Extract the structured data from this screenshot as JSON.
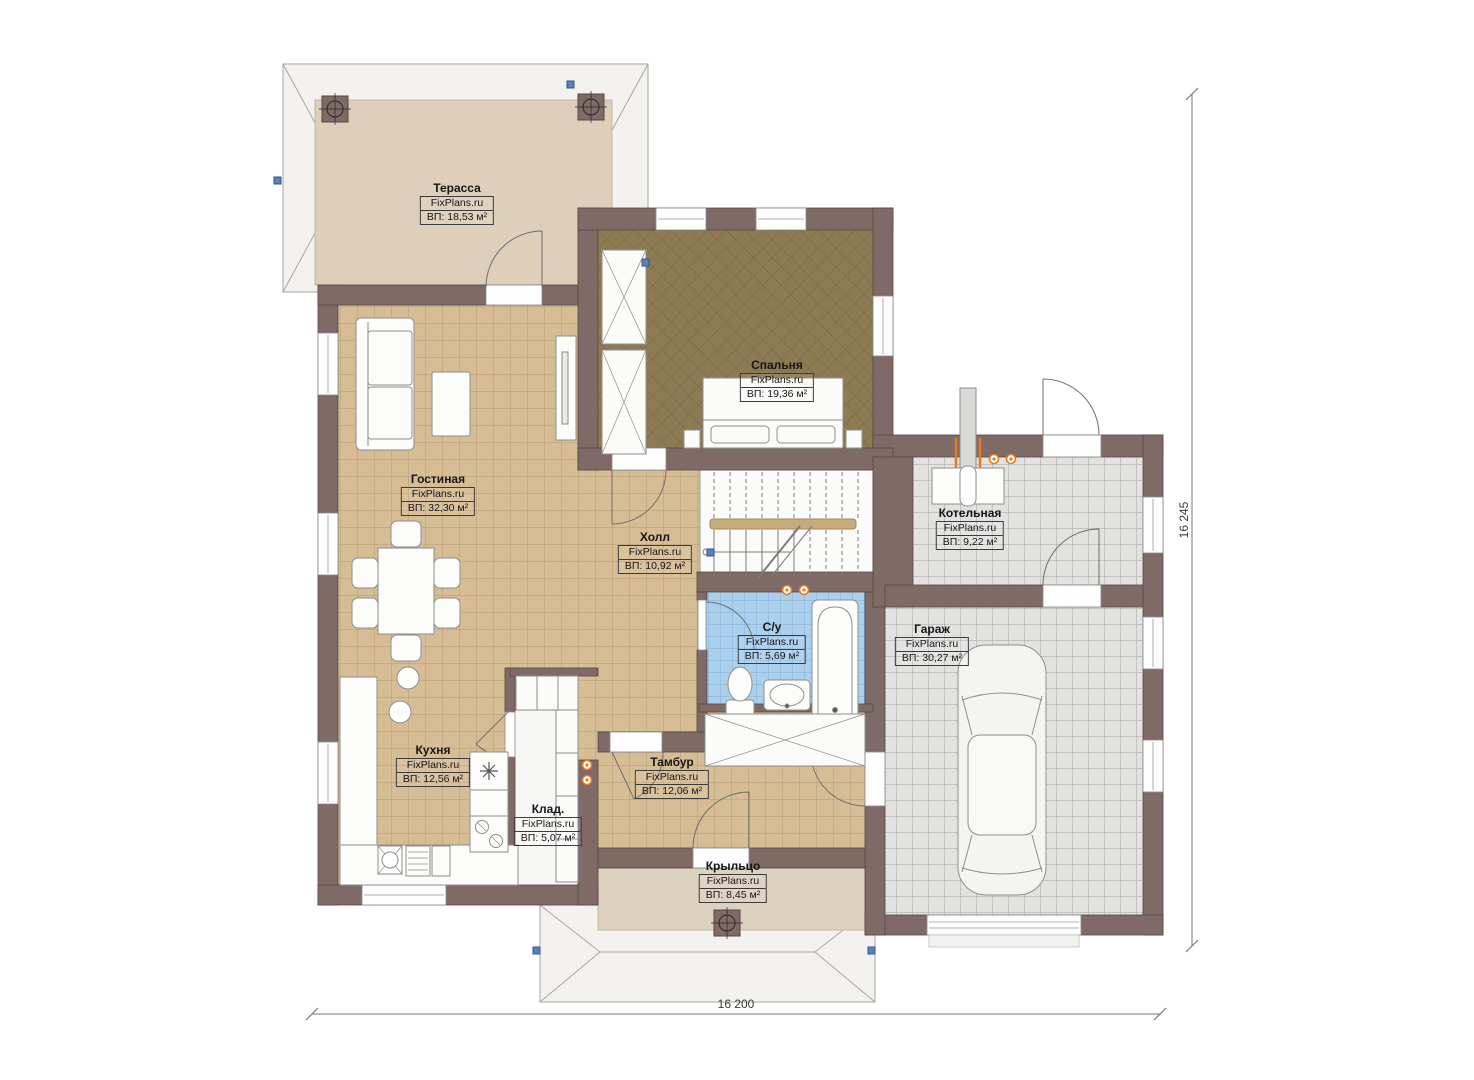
{
  "rooms": [
    {
      "key": "terrace",
      "name": "Терасса",
      "brand": "FixPlans.ru",
      "area": "ВП: 18,53 м²"
    },
    {
      "key": "bedroom",
      "name": "Спальня",
      "brand": "FixPlans.ru",
      "area": "ВП: 19,36 м²"
    },
    {
      "key": "living_room",
      "name": "Гостиная",
      "brand": "FixPlans.ru",
      "area": "ВП: 32,30 м²"
    },
    {
      "key": "hall",
      "name": "Холл",
      "brand": "FixPlans.ru",
      "area": "ВП: 10,92 м²"
    },
    {
      "key": "boiler_room",
      "name": "Котельная",
      "brand": "FixPlans.ru",
      "area": "ВП: 9,22 м²"
    },
    {
      "key": "bathroom",
      "name": "С/у",
      "brand": "FixPlans.ru",
      "area": "ВП: 5,69 м²"
    },
    {
      "key": "garage",
      "name": "Гараж",
      "brand": "FixPlans.ru",
      "area": "ВП: 30,27 м²"
    },
    {
      "key": "kitchen",
      "name": "Кухня",
      "brand": "FixPlans.ru",
      "area": "ВП: 12,56 м²"
    },
    {
      "key": "storage",
      "name": "Клад.",
      "brand": "FixPlans.ru",
      "area": "ВП: 5,07 м²"
    },
    {
      "key": "vestibule",
      "name": "Тамбур",
      "brand": "FixPlans.ru",
      "area": "ВП: 12,06 м²"
    },
    {
      "key": "porch",
      "name": "Крыльцо",
      "brand": "FixPlans.ru",
      "area": "ВП: 8,45 м²"
    }
  ],
  "dimensions": {
    "width": "16 200",
    "height": "16 245"
  },
  "colors": {
    "wall": "#7f6a67",
    "floor_tan": "#d6bd95",
    "floor_bedroom": "#8d7b53",
    "floor_bathroom": "#abd0ee",
    "floor_garage": "#e2e2e0",
    "floor_terrace": "#ddcfba",
    "electrical_accent": "#ea7a1f",
    "selection_handle": "#5d80b8"
  }
}
